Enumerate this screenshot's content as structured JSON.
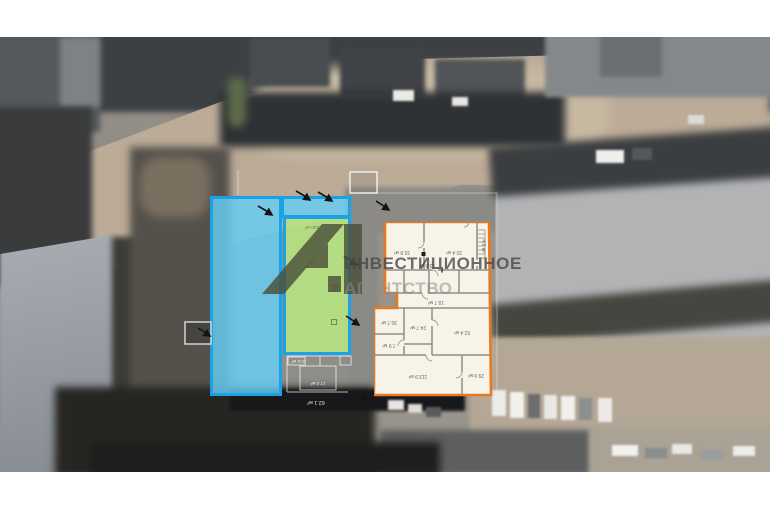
{
  "watermark": {
    "logo_text": "А1",
    "line1": "ИНВЕСТИЦИОННОЕ",
    "line2": "АГЕНТСТВО"
  },
  "green_zone": {
    "label": "430 м²"
  },
  "plan": {
    "rooms": [
      {
        "name": "upper-left",
        "area": "33.8 м²"
      },
      {
        "name": "upper-right",
        "area": "20.4 м²"
      },
      {
        "name": "center-small",
        "area": "13.3 м²"
      },
      {
        "name": "stair-side",
        "area": "4.9 м²"
      },
      {
        "name": "corridor",
        "area": "19.7 м²"
      },
      {
        "name": "mid-left",
        "area": "30.7 м²"
      },
      {
        "name": "mid-center",
        "area": "24.7 м²"
      },
      {
        "name": "small-left",
        "area": "7.9 м²"
      },
      {
        "name": "mid-right",
        "area": "52.4 м²"
      },
      {
        "name": "bottom-large",
        "area": "113.9 м²"
      },
      {
        "name": "bottom-right",
        "area": "29.9 м²"
      }
    ]
  },
  "site_labels": [
    {
      "area": "10.5 м²"
    },
    {
      "area": "17.0 м²"
    },
    {
      "area": "62.1 м²"
    }
  ],
  "colors": {
    "blue_outline": "#1ba2e6",
    "blue_fill": "#65cef4",
    "green_fill": "#b6e281",
    "orange_outline": "#e8791f",
    "plan_fill": "#f8f3e8",
    "watermark_gray": "#484848",
    "logo_olive": "#4a4f3c"
  }
}
